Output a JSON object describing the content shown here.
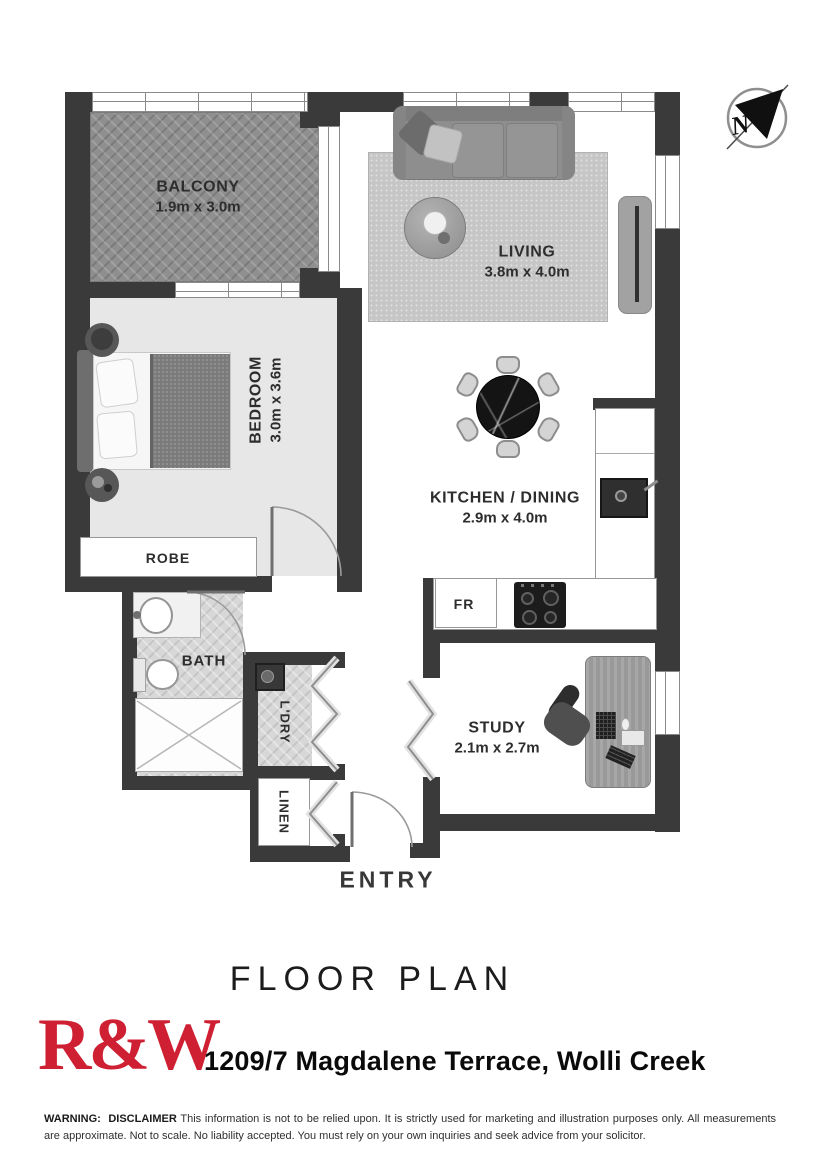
{
  "compass": {
    "north_letter": "N"
  },
  "rooms": {
    "balcony": {
      "name": "BALCONY",
      "dims": "1.9m x 3.0m"
    },
    "living": {
      "name": "LIVING",
      "dims": "3.8m x 4.0m"
    },
    "bedroom": {
      "name": "BEDROOM",
      "dims": "3.0m x 3.6m"
    },
    "kitchen_dining": {
      "name": "KITCHEN / DINING",
      "dims": "2.9m x 4.0m"
    },
    "study": {
      "name": "STUDY",
      "dims": "2.1m x 2.7m"
    },
    "robe": {
      "name": "ROBE"
    },
    "bath": {
      "name": "BATH"
    },
    "laundry": {
      "name": "L'DRY"
    },
    "linen": {
      "name": "LINEN"
    },
    "fridge": {
      "name": "FR"
    },
    "entry": {
      "name": "ENTRY"
    }
  },
  "footer": {
    "plan_title": "FLOOR PLAN",
    "brand": "R&W",
    "address": "1209/7 Magdalene Terrace, Wolli Creek",
    "warning_label": "WARNING:",
    "disclaimer_label": "DISCLAIMER",
    "disclaimer_text": "This information is not to be relied upon.  It is strictly used for marketing and illustration purposes only. All measurements are approximate.  Not to scale.  No liability accepted. You must rely on your own inquiries and seek advice from your solicitor."
  },
  "colors": {
    "wall": "#3a3a3a",
    "brand_red": "#cf2033"
  }
}
